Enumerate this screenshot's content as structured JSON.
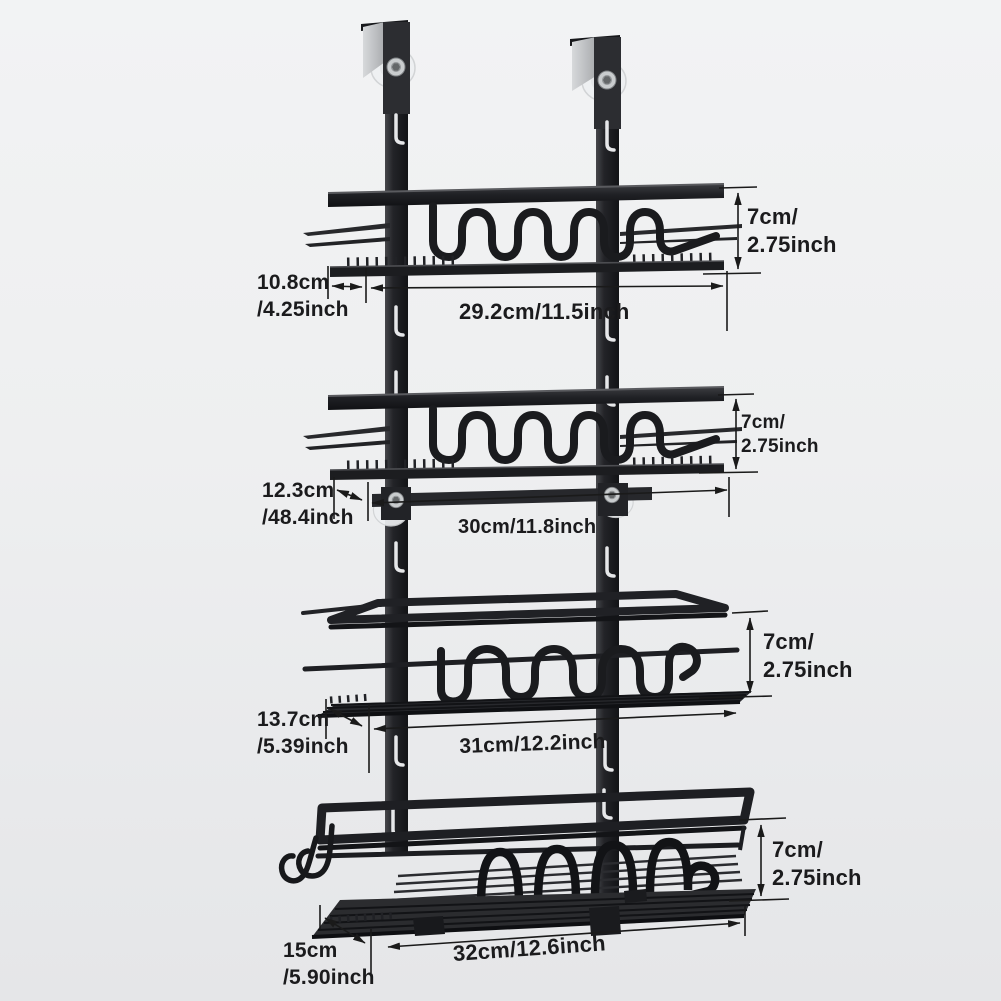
{
  "page": {
    "type": "product-dimension-diagram",
    "product": "4-tier over-door hanging storage rack",
    "metal_color": "#1c1d20",
    "annotation_color": "#1a1a1a",
    "background_top": "#f2f3f4",
    "background_bottom": "#e5e6e8"
  },
  "measurements": {
    "tier1": {
      "height": "7cm/\n2.75inch",
      "depth": "10.8cm\n/4.25inch",
      "width": "29.2cm/11.5inch"
    },
    "tier2": {
      "height": "7cm/\n2.75inch",
      "depth": "12.3cm\n/48.4inch",
      "width": "30cm/11.8inch"
    },
    "tier3": {
      "height": "7cm/\n2.75inch",
      "depth": "13.7cm\n/5.39inch",
      "width": "31cm/12.2inch"
    },
    "tier4": {
      "height": "7cm/\n2.75inch",
      "depth": "15cm\n/5.90inch",
      "width": "32cm/12.6inch"
    }
  }
}
